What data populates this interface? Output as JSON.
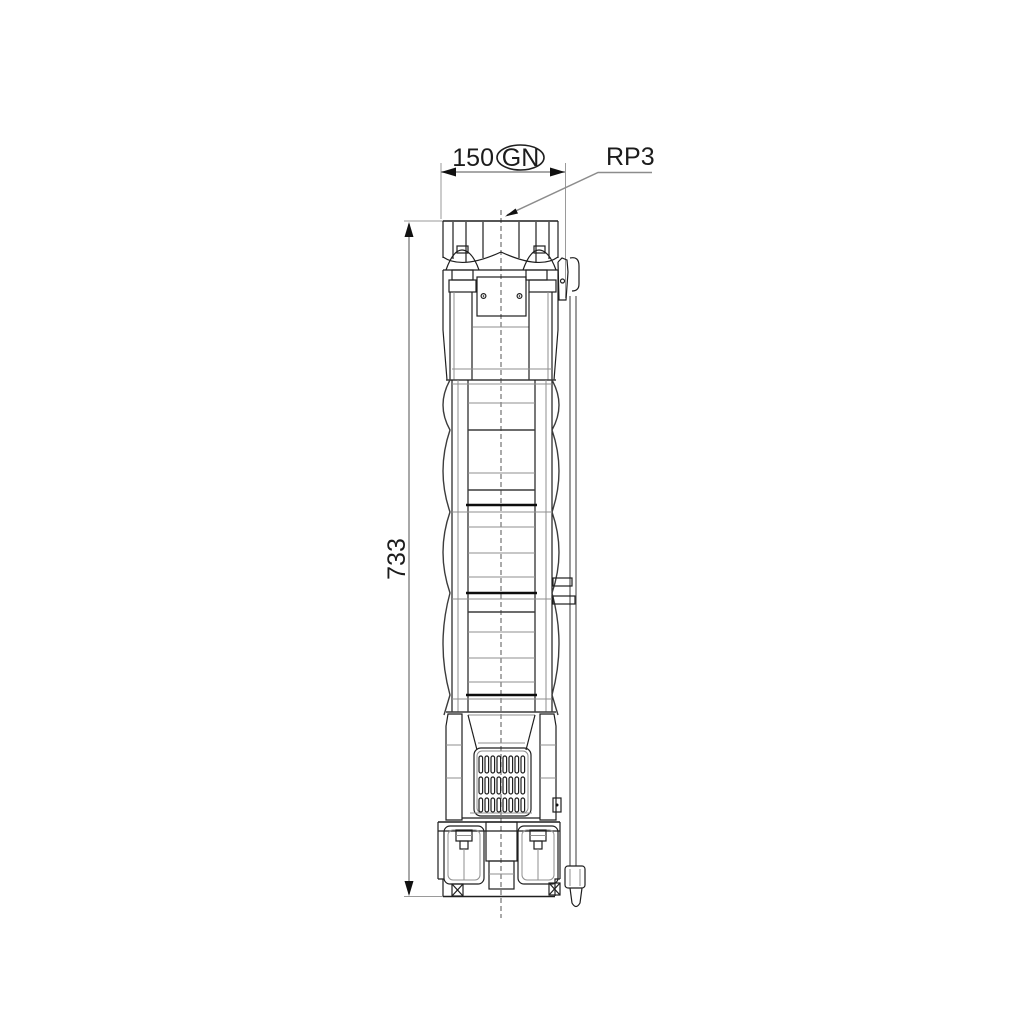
{
  "drawing": {
    "labels": {
      "width_dim": "150",
      "flange_code": "GN",
      "connection": "RP3",
      "height_dim": "733"
    },
    "colors": {
      "line": "#1f1f1f",
      "dim_line": "#8c8c8c",
      "text": "#1c1c1c",
      "background": "#ffffff"
    }
  }
}
